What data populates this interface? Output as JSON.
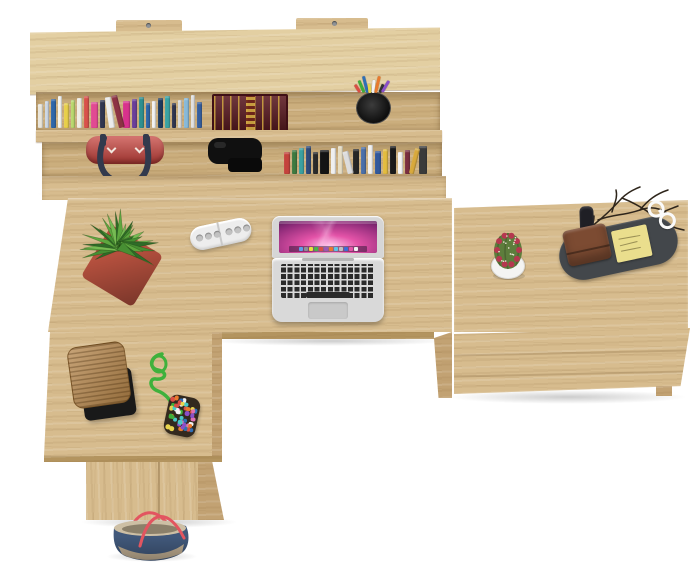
{
  "canvas": {
    "width": 700,
    "height": 565,
    "background": "#ffffff"
  },
  "palette": {
    "wood": "#d7bc8e",
    "wood_light": "#e3cfa2",
    "wood_cavity": "#cbae7d",
    "wood_side": "#c2a273",
    "wood_edge": "#b3945f"
  },
  "shelf": {
    "row1_books": [
      {
        "c": "#e9e5da",
        "w": 5
      },
      {
        "c": "#cdd7e3",
        "w": 4
      },
      {
        "c": "#2f66a8",
        "w": 5
      },
      {
        "c": "#f5f5f0",
        "w": 4
      },
      {
        "c": "#e8cf4a",
        "w": 5
      },
      {
        "c": "#b9d86e",
        "w": 4
      },
      {
        "c": "#f0ede4",
        "w": 5
      },
      {
        "c": "#d8524a",
        "w": 5
      },
      {
        "c": "#e14a92",
        "w": 7
      },
      {
        "c": "#30354f",
        "w": 5
      },
      {
        "c": "#ececec",
        "w": 6,
        "r": -8
      },
      {
        "c": "#8c3344",
        "w": 6,
        "r": -14
      },
      {
        "c": "#d8328c",
        "w": 7
      },
      {
        "c": "#6a3f99",
        "w": 5
      },
      {
        "c": "#2e8f8f",
        "w": 5
      },
      {
        "c": "#2f66a8",
        "w": 4
      },
      {
        "c": "#f2f2f2",
        "w": 4
      },
      {
        "c": "#1f3a5e",
        "w": 5
      },
      {
        "c": "#3aa3a3",
        "w": 5
      },
      {
        "c": "#30354f",
        "w": 4
      },
      {
        "c": "#d9d9d9",
        "w": 4
      },
      {
        "c": "#87b9d9",
        "w": 5
      },
      {
        "c": "#e1e1e1",
        "w": 4
      },
      {
        "c": "#355e9e",
        "w": 5
      }
    ],
    "row2_books": [
      {
        "c": "#c4433c",
        "w": 6
      },
      {
        "c": "#3f7a3f",
        "w": 5
      },
      {
        "c": "#3aa0a0",
        "w": 5
      },
      {
        "c": "#2e4a7a",
        "w": 5
      },
      {
        "c": "#2b2b2b",
        "w": 5
      },
      {
        "c": "#141414",
        "w": 9
      },
      {
        "c": "#efefef",
        "w": 5
      },
      {
        "c": "#e6dcc2",
        "w": 5
      },
      {
        "c": "#dcdcdc",
        "w": 6,
        "r": -14
      },
      {
        "c": "#262626",
        "w": 6
      },
      {
        "c": "#4a6fa8",
        "w": 5
      },
      {
        "c": "#f0f0f0",
        "w": 5
      },
      {
        "c": "#31589b",
        "w": 6
      },
      {
        "c": "#e3bc3f",
        "w": 5
      },
      {
        "c": "#1a1a1a",
        "w": 6
      },
      {
        "c": "#f4f4f4",
        "w": 5
      },
      {
        "c": "#7a2e3f",
        "w": 5
      },
      {
        "c": "#d8a93c",
        "w": 5,
        "r": 14
      },
      {
        "c": "#3a3a3a",
        "w": 8
      }
    ],
    "big_book": {
      "cover": "#5c1b22",
      "gilt": "#d1a842"
    },
    "pens": [
      "#d94f45",
      "#3fae3a",
      "#2e6fb7",
      "#e8d44e",
      "#f2f2f2",
      "#e87a2e",
      "#333333",
      "#8a4fc8"
    ],
    "bag": {
      "body": "#c5403a",
      "strap": "#333a4d"
    },
    "headphones": "#101010"
  },
  "desk": {
    "plant": {
      "pot": "#b5503e",
      "greens": [
        "#2f6b28",
        "#478f33",
        "#5ea73f",
        "#76bb53"
      ]
    },
    "organizer": {
      "body": "#ededed",
      "holes": "#c2c2c2"
    },
    "laptop": {
      "body": "#d9d9d9",
      "keys": "#2b2b2b",
      "trackpad": "#c9c9c9",
      "screen": {
        "glow": "#ffc9ec",
        "mid": "#e453a8",
        "deep": "#8c2a78",
        "dark": "#241038"
      },
      "dock": [
        "#5aa0e8",
        "#8a8f98",
        "#e8e13c",
        "#48b648",
        "#d94f45",
        "#9b59b6",
        "#e87a2e",
        "#5ac8e8",
        "#c0c0c0",
        "#3a6fd8",
        "#e453a8",
        "#f2f2f2"
      ]
    }
  },
  "sideboard": {
    "cactus": {
      "pot": "#f4f4f2",
      "body": "#5d7d3c",
      "flowers": "#b5384f",
      "spines": "#ece7d6"
    },
    "tray": "#43474b",
    "wallet": "#7c4b32",
    "notepad": "#eade8d",
    "glasses": "#fafafa",
    "twigs": "#2e251b",
    "watch_strap": "#1f1f25"
  },
  "return_desk": {
    "stack": {
      "paper": "#b5854a",
      "base": "#191919"
    },
    "pom": {
      "rope": "#3fb13c",
      "pouch_bg": "#33291e",
      "dots": [
        "#d94f45",
        "#3fae3a",
        "#2e6fb7",
        "#e8d44e",
        "#e06fb0",
        "#f2f2f2",
        "#e87a2e",
        "#8a4fc8",
        "#49c8c8"
      ]
    }
  },
  "floor_bag": {
    "denim": "#41587a",
    "handles": "#e25560",
    "trim": "#bcab90",
    "inner": "#cdbfa4"
  }
}
